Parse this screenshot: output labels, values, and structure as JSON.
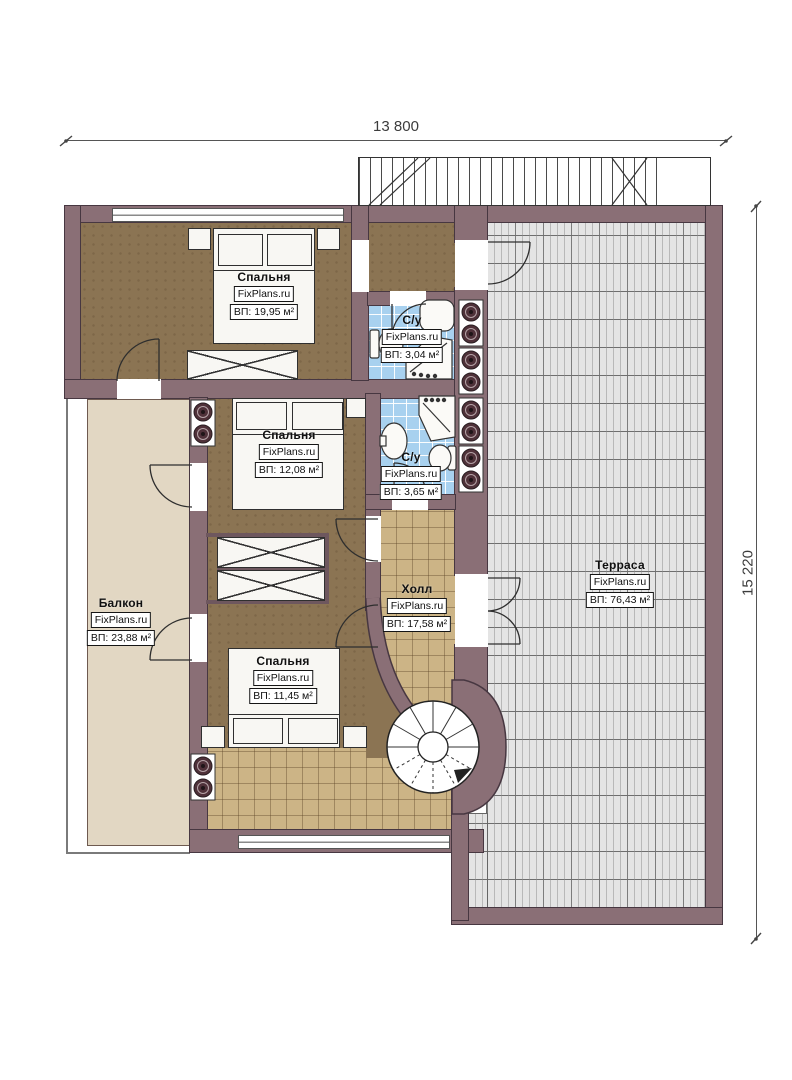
{
  "dimensions": {
    "width_label": "13 800",
    "height_label": "15 220"
  },
  "branding": {
    "site": "FixPlans.ru"
  },
  "rooms": {
    "bedroom_top": {
      "name": "Спальня",
      "area": "ВП: 19,95 м²"
    },
    "bathroom_top": {
      "name": "С/у",
      "area": "ВП: 3,04 м²"
    },
    "bedroom_middle": {
      "name": "Спальня",
      "area": "ВП: 12,08 м²"
    },
    "bathroom_middle": {
      "name": "С/у",
      "area": "ВП: 3,65 м²"
    },
    "bedroom_bottom": {
      "name": "Спальня",
      "area": "ВП: 11,45 м²"
    },
    "hall": {
      "name": "Холл",
      "area": "ВП: 17,58 м²"
    },
    "balcony": {
      "name": "Балкон",
      "area": "ВП: 23,88 м²"
    },
    "terrace": {
      "name": "Терраса",
      "area": "ВП: 76,43 м²"
    }
  },
  "colors": {
    "wall": "#8a6f76",
    "wall_outline": "#473741",
    "bedroom_floor": "#8b7453",
    "hall_floor": "#ccb486",
    "balcony_floor": "#e2d7c3",
    "bathroom_floor": "#a8d1ef",
    "terrace_floor": "#e4e4e4",
    "fixture_circle": "#4f3139"
  }
}
